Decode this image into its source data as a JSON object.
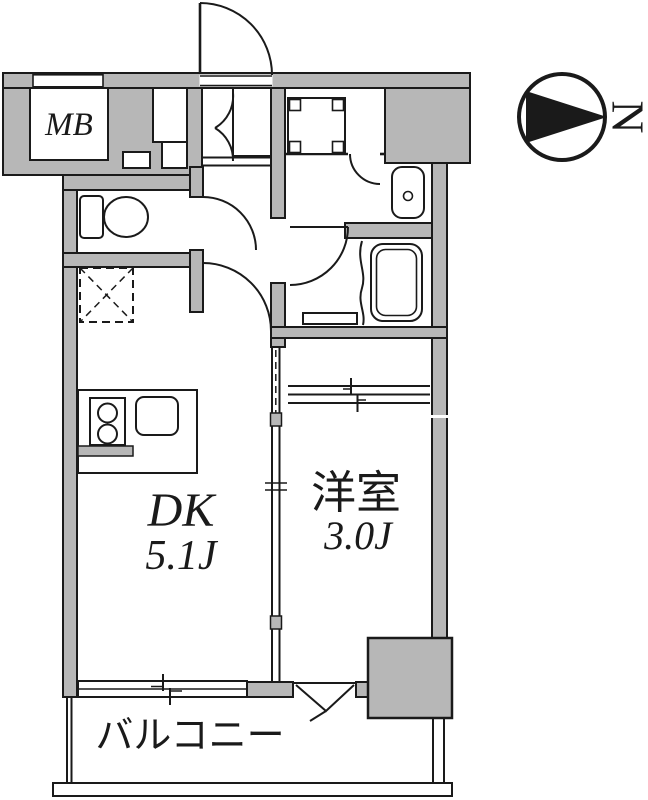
{
  "page": {
    "background": "#ffffff"
  },
  "colors": {
    "wall_fill": "#b7b7b7",
    "outline": "#1a1a1a"
  },
  "floor_plan": {
    "rooms": [
      {
        "id": "meter_box",
        "label": "MB"
      },
      {
        "id": "dining_kitchen",
        "label": "DK",
        "size": "5.1J"
      },
      {
        "id": "western_room",
        "label": "洋室",
        "size": "3.0J"
      },
      {
        "id": "balcony",
        "label": "バルコニー"
      }
    ],
    "compass": {
      "label": "N",
      "points": "right"
    },
    "fixtures": [
      "entrance-door",
      "shoe-cabinet-doors",
      "hall-step",
      "toilet",
      "refrigerator-space",
      "washing-machine-pan",
      "washroom-door",
      "wash-basin",
      "bathtub",
      "bath-folding-door",
      "wc-door",
      "dk-door",
      "kitchen-counter",
      "stove",
      "sink",
      "counter-base-wall",
      "dk-partition-sliding-door",
      "closet-sliding-door",
      "balcony-sliding-window",
      "balcony-opening",
      "pillar",
      "balcony-rail",
      "north-compass"
    ]
  }
}
